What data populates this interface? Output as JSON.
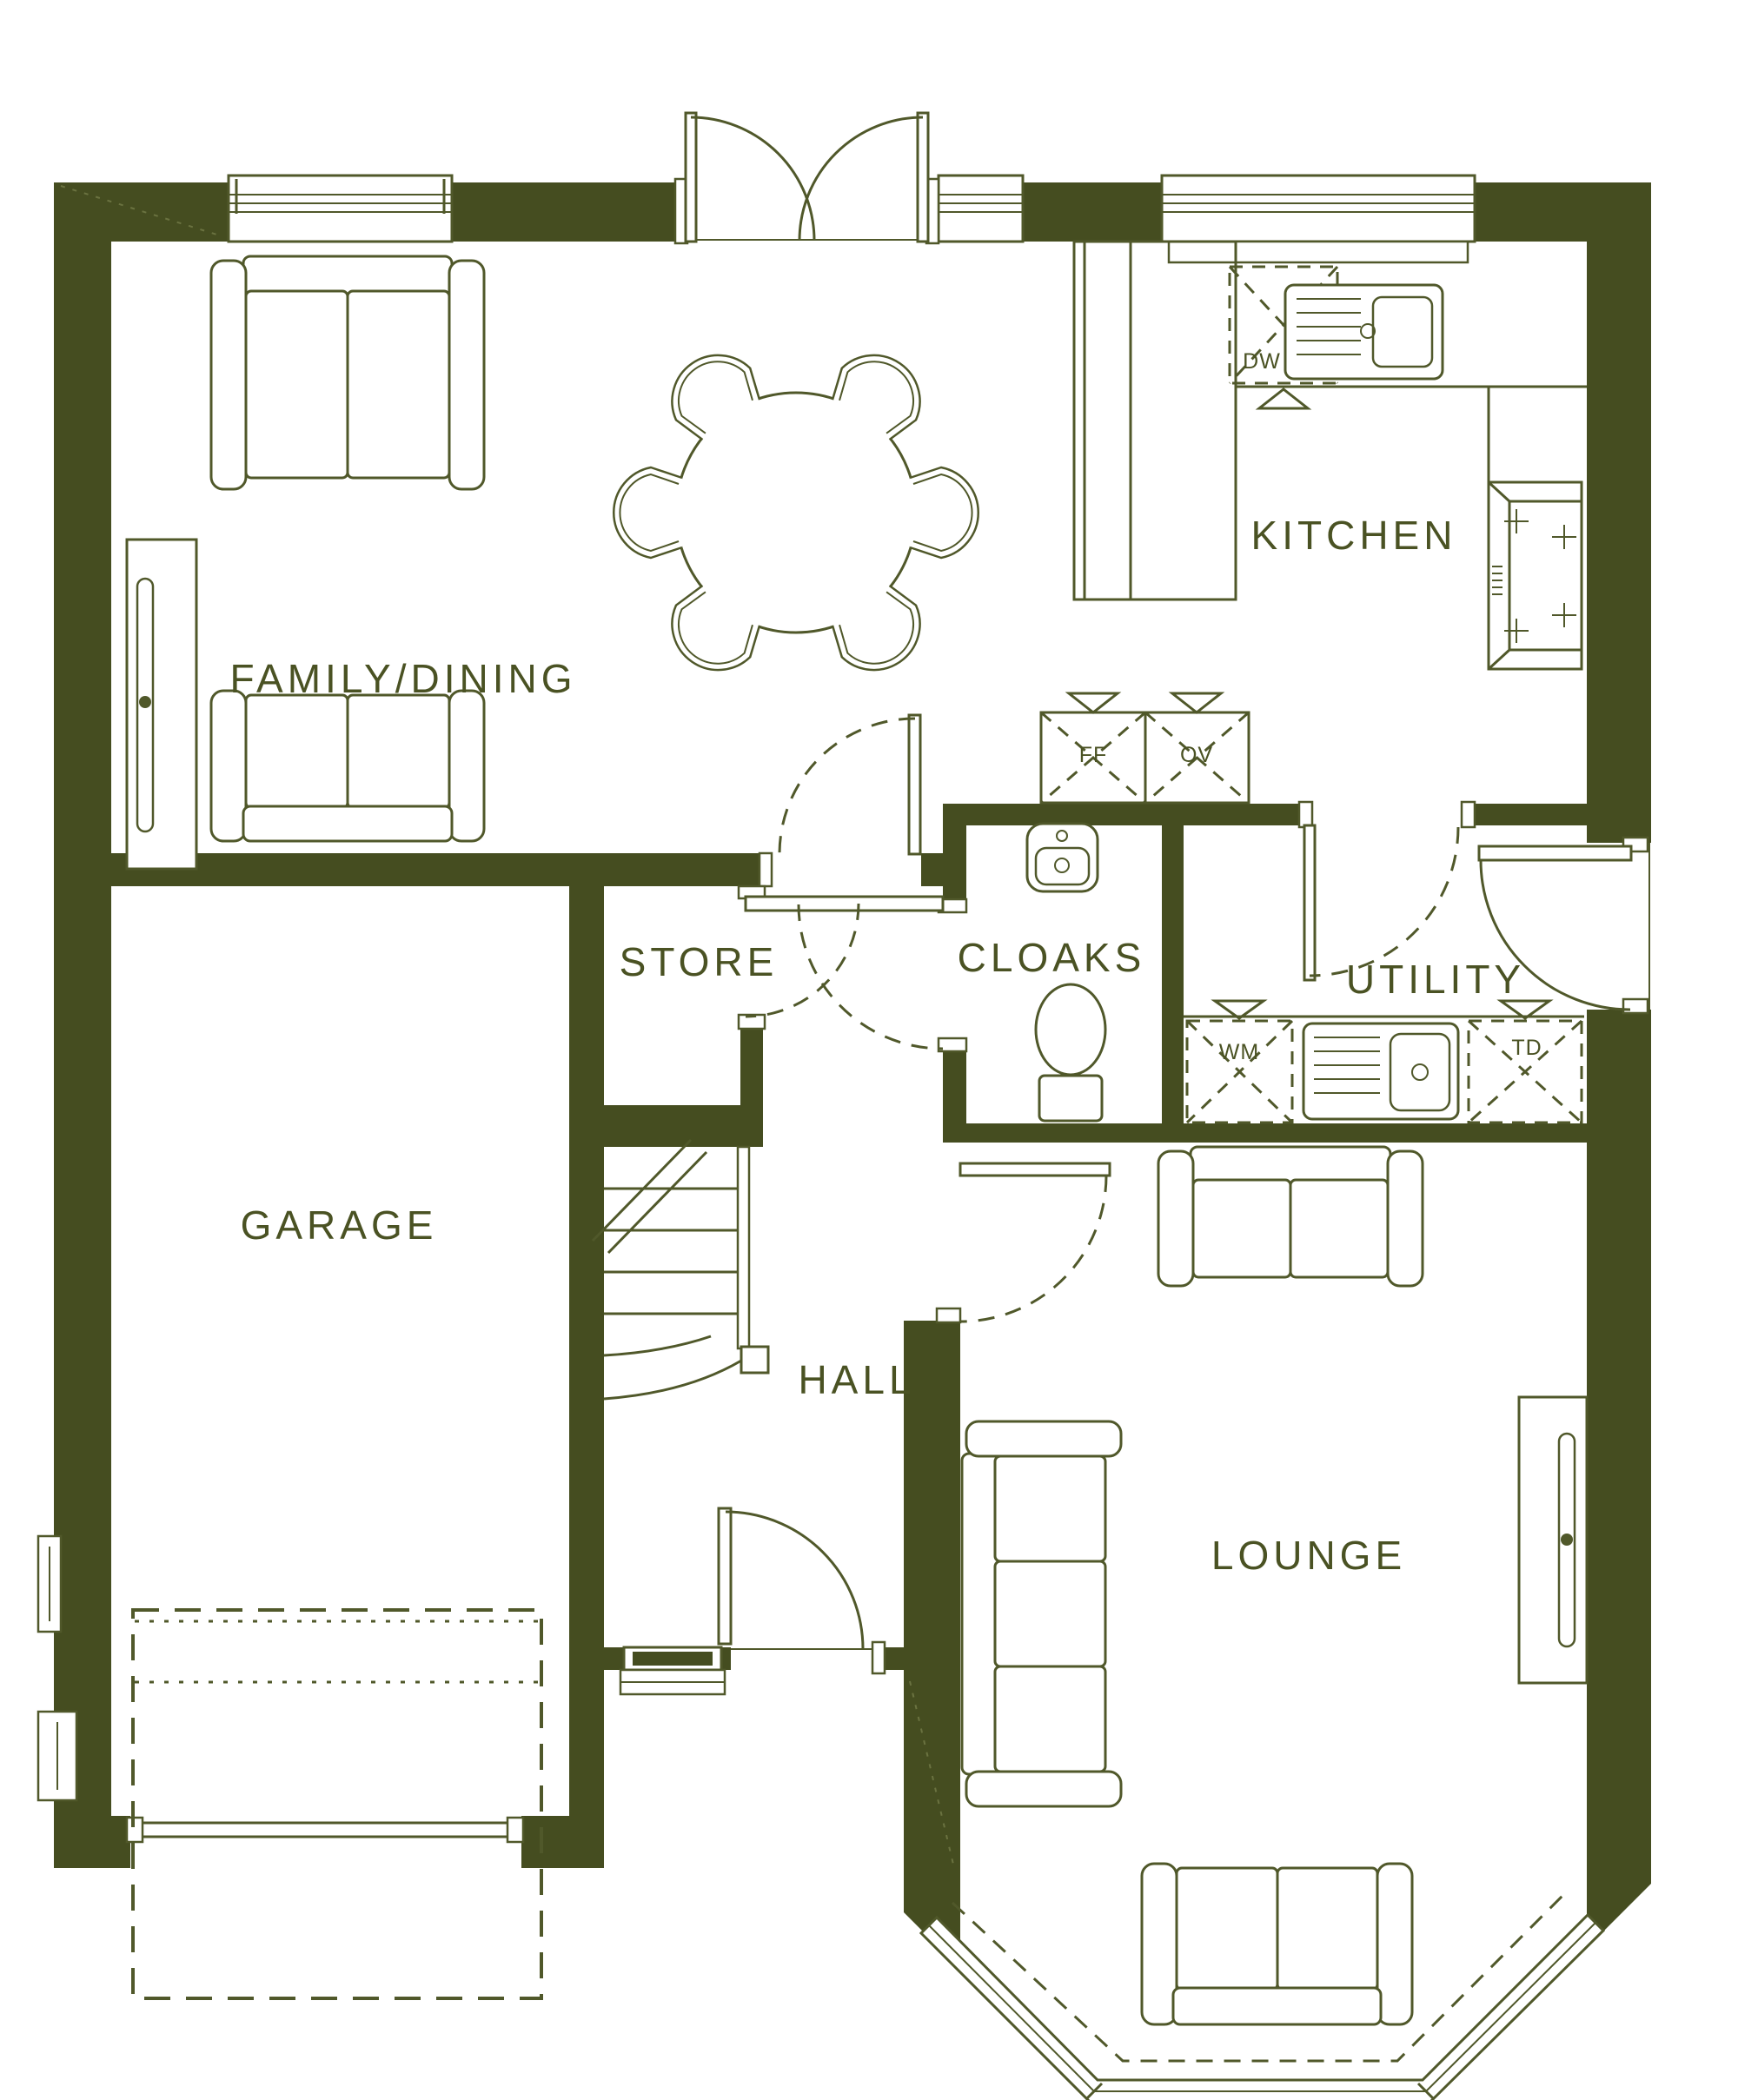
{
  "title": "Ground floor plan",
  "colors": {
    "wall": "#454d20",
    "line": "#50582a",
    "text": "#4a5223",
    "bg": "#ffffff"
  },
  "rooms": [
    {
      "id": "family-dining",
      "label": "FAMILY/DINING"
    },
    {
      "id": "kitchen",
      "label": "KITCHEN"
    },
    {
      "id": "store",
      "label": "STORE"
    },
    {
      "id": "cloaks",
      "label": "CLOAKS"
    },
    {
      "id": "utility",
      "label": "UTILITY"
    },
    {
      "id": "garage",
      "label": "GARAGE"
    },
    {
      "id": "hall",
      "label": "HALL"
    },
    {
      "id": "lounge",
      "label": "LOUNGE"
    }
  ],
  "appliances": [
    {
      "id": "dishwasher",
      "label": "DW"
    },
    {
      "id": "fridge-freezer",
      "label": "FF"
    },
    {
      "id": "oven",
      "label": "OV"
    },
    {
      "id": "washing-machine",
      "label": "WM"
    },
    {
      "id": "tumble-dryer",
      "label": "TD"
    }
  ]
}
